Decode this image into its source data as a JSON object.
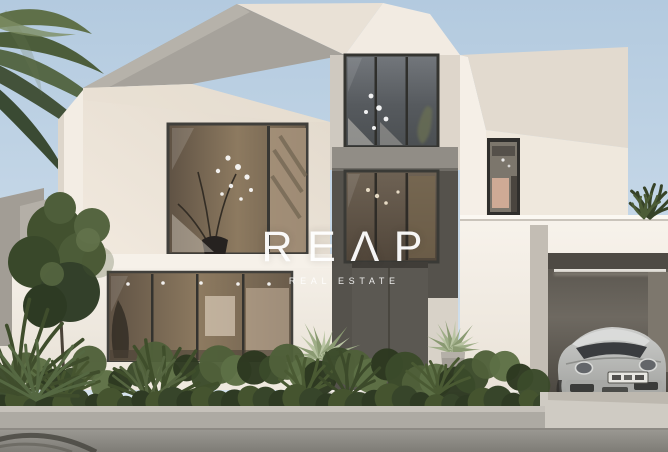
{
  "meta": {
    "kind": "real-estate listing photograph (architectural rendering)",
    "subject": "Modern two-storey white villa with angular geometric volumes, double-height glazed entrance, landscaped hedge, palm trees and an open garage containing a silver sports car",
    "conditions": "daytime, clear pale-blue sky"
  },
  "watermark": {
    "brand": "REAP",
    "tagline": "REAL ESTATE",
    "color": "#ffffff"
  },
  "palette": {
    "sky_top": "#b3cadf",
    "sky_bottom": "#dde8f1",
    "wall_bright": "#f5efe7",
    "wall_cream": "#ece3d7",
    "wall_shadow": "#a8a49d",
    "frame_dark": "#3c3b37",
    "glass_cool": "#5d6164",
    "interior_warm": "#8a7458",
    "band_gray": "#918d86",
    "door_gray": "#5b5852",
    "garage_interior": "#6b665e",
    "car_silver": "#b7b8b6",
    "hedge_green": "#35422a",
    "agave_green": "#a9b694",
    "curb": "#adaaa3",
    "driveway": "#cfcbc3",
    "road": "#96948e"
  },
  "scene": {
    "elements": [
      "palm tree fronds (top left)",
      "neighbouring tree and grey boundary wall",
      "angular cream villa volumes with folded roof planes",
      "upper lounge window with branch chandelier",
      "double-height entrance glazing",
      "dark pivot entrance door",
      "two potted agave plants flanking the door",
      "ground-floor living room glazing",
      "narrow gallery window on right volume",
      "open garage with linear ceiling light",
      "silver sports car with blurred license plate",
      "boxwood hedge, grasses and planter curb",
      "asphalt road with tire mark"
    ]
  }
}
